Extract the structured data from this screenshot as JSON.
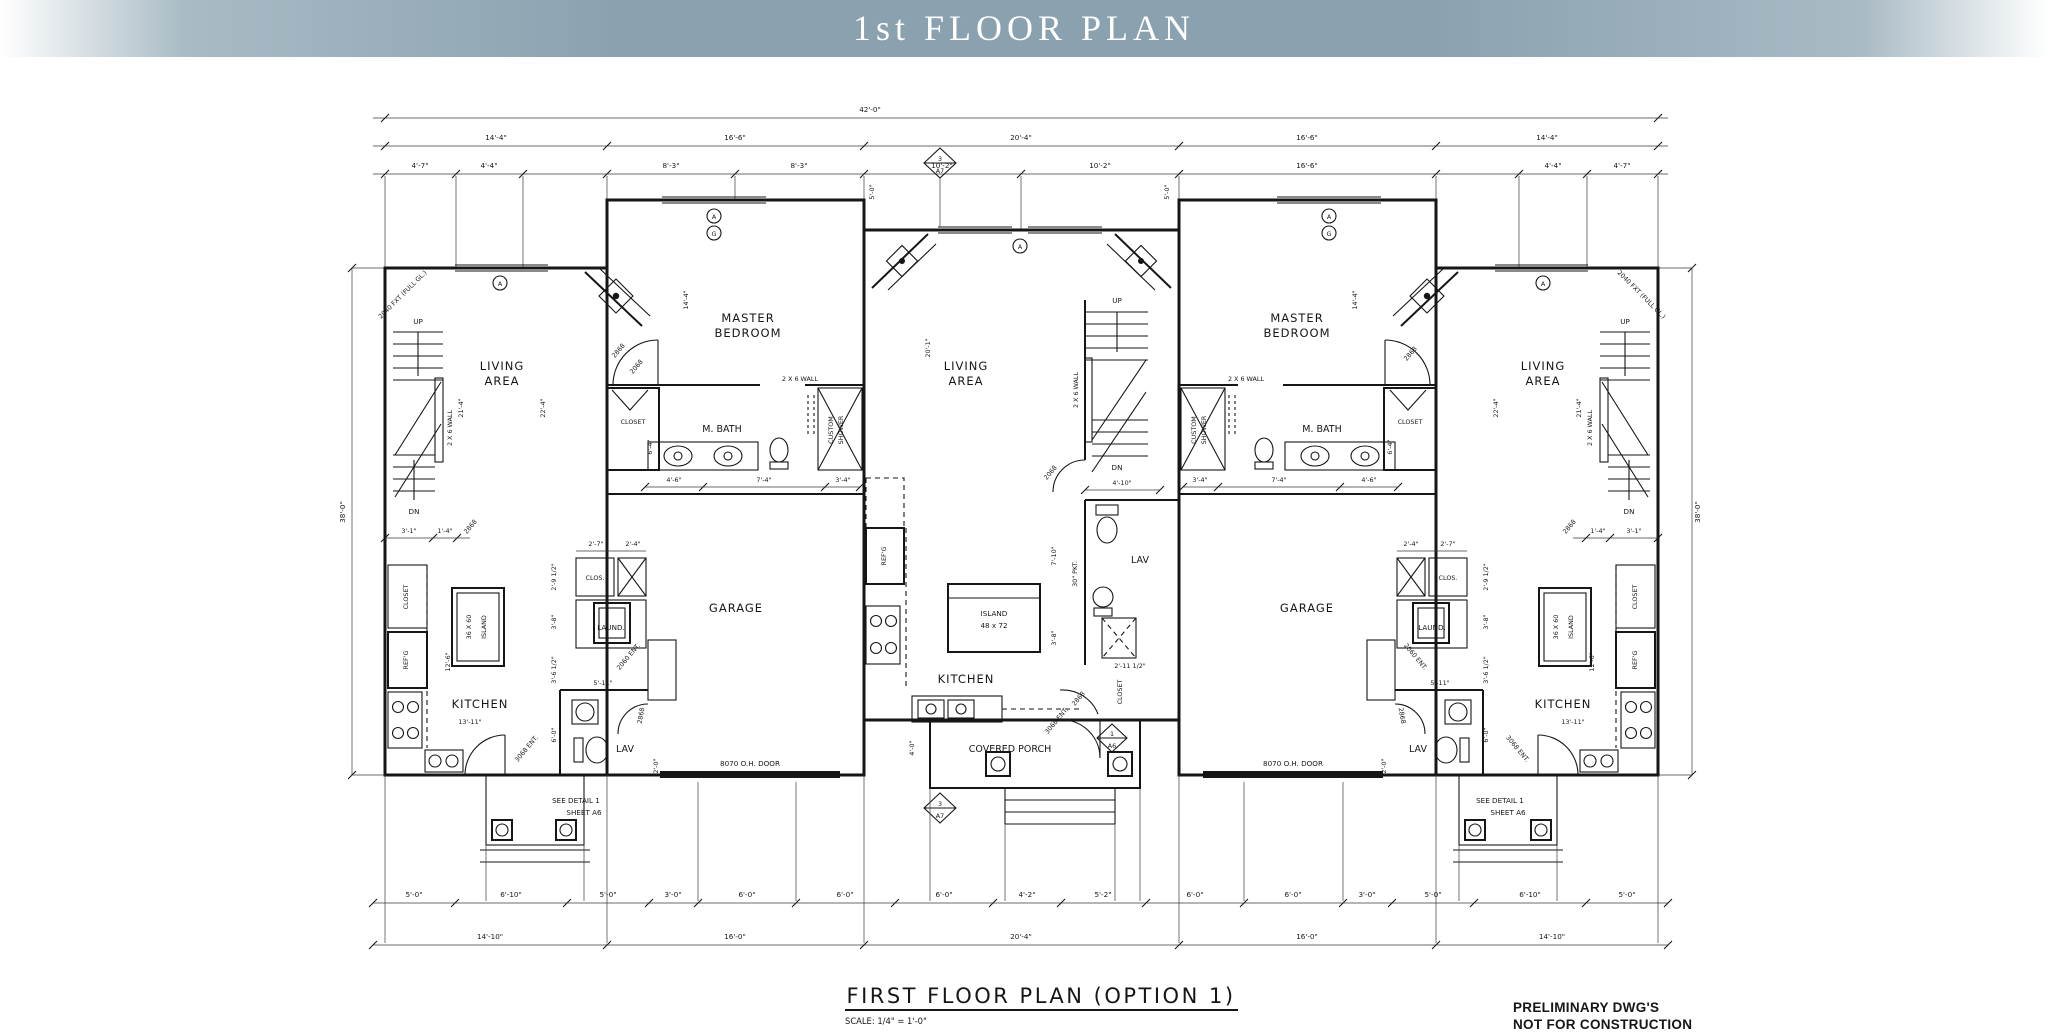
{
  "banner": {
    "title": "1st FLOOR PLAN"
  },
  "footer": {
    "title": "FIRST FLOOR PLAN (OPTION 1)",
    "scale": "SCALE: 1/4\" = 1'-0\"",
    "prelim1": "PRELIMINARY DWG'S",
    "prelim2": "NOT FOR CONSTRUCTION"
  },
  "rooms": {
    "living1": "LIVING",
    "living2": "AREA",
    "master1": "MASTER",
    "master2": "BEDROOM",
    "mbath": "M. BATH",
    "garage": "GARAGE",
    "kitchen": "KITCHEN",
    "lav": "LAV",
    "laund": "LAUND.",
    "clos": "CLOS.",
    "closet": "CLOSET",
    "porch": "COVERED PORCH",
    "shower1": "CUSTOM",
    "shower2": "SHOWER",
    "refg": "REF'G",
    "island36a": "36 X 60",
    "island36b": "ISLAND",
    "island48a": "ISLAND",
    "island48b": "48 x 72"
  },
  "misc": {
    "up": "UP",
    "dn": "DN",
    "wall26": "2 X 6 WALL",
    "ohdoor": "8070 O.H. DOOR",
    "ent3068": "3068 ENT.",
    "ent2060": "2060 ENT.",
    "d2868": "2868",
    "d2068": "2068",
    "fullgl": "2040 FXT (FULL GL.)",
    "pkt": "30\" PKT.",
    "det1": "SEE DETAIL 1",
    "det2": "SHEET A6",
    "m3": "3",
    "mA7": "A7",
    "m1": "1",
    "mA6": "A6",
    "mA": "A",
    "mG": "G"
  },
  "dims": {
    "overall": "42'-0\"",
    "top2": [
      "14'-4\"",
      "16'-6\"",
      "20'-4\"",
      "16'-6\"",
      "14'-4\""
    ],
    "top3": [
      "4'-7\"",
      "4'-4\"",
      "8'-3\"",
      "8'-3\"",
      "10'-2\"",
      "10'-2\"",
      "16'-6\"",
      "4'-4\"",
      "4'-7\""
    ],
    "bot1": [
      "5'-0\"",
      "6'-10\"",
      "5'-0\"",
      "3'-0\"",
      "6'-0\"",
      "6'-0\"",
      "6'-0\"",
      "4'-2\"",
      "5'-2\"",
      "6'-0\"",
      "6'-0\"",
      "3'-0\"",
      "5'-0\"",
      "6'-10\"",
      "5'-0\""
    ],
    "bot2": [
      "14'-10\"",
      "16'-0\"",
      "20'-4\"",
      "16'-0\"",
      "14'-10\""
    ],
    "side": "38'-0\"",
    "d21_4": "21'-4\"",
    "d22_4": "22'-4\"",
    "d20_1": "20'-1\"",
    "d14_4": "14'-4\"",
    "d13_11": "13'-11\"",
    "d12_6": "12'-6\"",
    "d5_11": "5'-11\"",
    "d6_4": "6'-4\"",
    "d6_0": "6'-0\"",
    "d5_0": "5'-0\"",
    "d4_10": "4'-10\"",
    "d3_4": "3'-4\"",
    "d7_4": "7'-4\"",
    "d4_6": "4'-6\"",
    "d3_1": "3'-1\"",
    "d1_4": "1'-4\"",
    "d2_7": "2'-7\"",
    "d2_4": "2'-4\"",
    "d2_9h": "2'-9 1/2\"",
    "d3_8": "3'-8\"",
    "d3_6h": "3'-6 1/2\"",
    "d2_11h": "2'-11 1/2\"",
    "d7_10": "7'-10\"",
    "d4_0": "4'-0\"",
    "d2_0": "2'-0\""
  }
}
